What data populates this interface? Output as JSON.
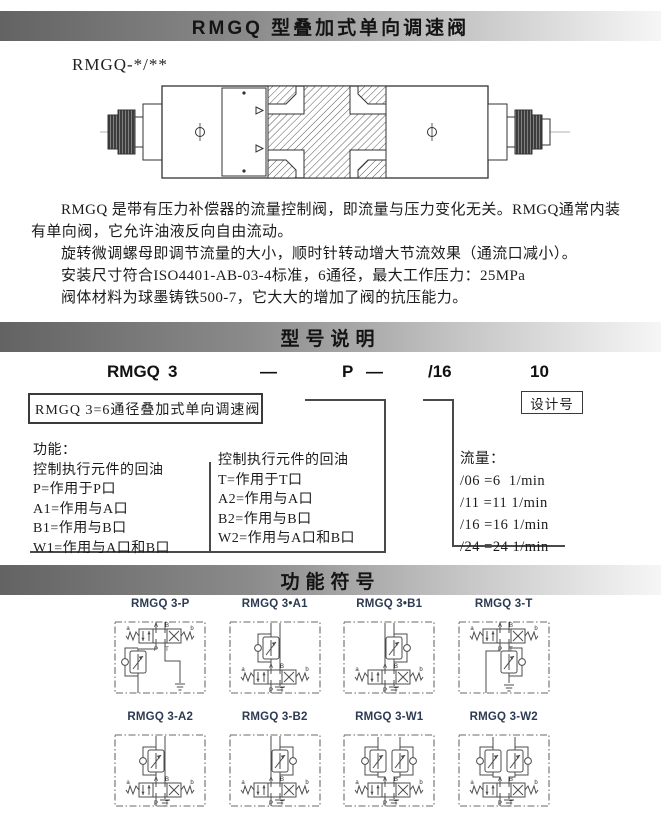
{
  "header_bar": {
    "title": "RMGQ 型叠加式单向调速阀"
  },
  "product_view": {
    "model_label": "RMGQ-*/**"
  },
  "description": {
    "paragraphs": [
      "RMGQ 是带有压力补偿器的流量控制阀，即流量与压力变化无关。RMGQ通常内装有单向阀，它允许油液反向自由流动。",
      "旋转微调螺母即调节流量的大小，顺时针转动增大节流效果（通流口减小）。",
      "安装尺寸符合ISO4401-AB-03-4标准，6通径，最大工作压力：25MPa",
      "阀体材料为球墨铸铁500-7，它大大的增加了阀的抗压能力。"
    ]
  },
  "model_section": {
    "bar_title": "型号说明",
    "code": {
      "series": "RMGQ",
      "size": "3",
      "dash1": "—",
      "function": "P",
      "dash2": "—",
      "flow": "/16",
      "design": "10"
    },
    "series_note": "RMGQ 3=6通径叠加式单向调速阀",
    "design_label": "设计号",
    "func_col1": [
      "功能：",
      "控制执行元件的回油",
      "P=作用于P口",
      "A1=作用与A口",
      "B1=作用与B口",
      "W1=作用与A口和B口"
    ],
    "func_col2": [
      "控制执行元件的回油",
      "T=作用于T口",
      "A2=作用与A口",
      "B2=作用与B口",
      "W2=作用与A口和B口"
    ],
    "flow_col": [
      "流量：",
      "/06 =6  1/min",
      "/11 =11 1/min",
      "/16 =16 1/min",
      "/24 =24 1/min"
    ]
  },
  "symbols_section": {
    "bar_title": "功能符号",
    "port_labels": {
      "a": "a",
      "b": "b",
      "A": "A",
      "B": "B",
      "P": "P",
      "T": "T"
    },
    "symbols": [
      {
        "label": "RMGQ 3-P",
        "variant": "P"
      },
      {
        "label": "RMGQ 3•A1",
        "variant": "A1"
      },
      {
        "label": "RMGQ 3•B1",
        "variant": "B1"
      },
      {
        "label": "RMGQ 3-T",
        "variant": "T"
      },
      {
        "label": "RMGQ 3-A2",
        "variant": "A2"
      },
      {
        "label": "RMGQ 3-B2",
        "variant": "B2"
      },
      {
        "label": "RMGQ 3-W1",
        "variant": "W1"
      },
      {
        "label": "RMGQ 3-W2",
        "variant": "W2"
      }
    ]
  },
  "colors": {
    "label": "#2d3b52",
    "line": "#4a4a4a",
    "bar_dark": "#636363",
    "bar_light": "#f6f6f6"
  }
}
